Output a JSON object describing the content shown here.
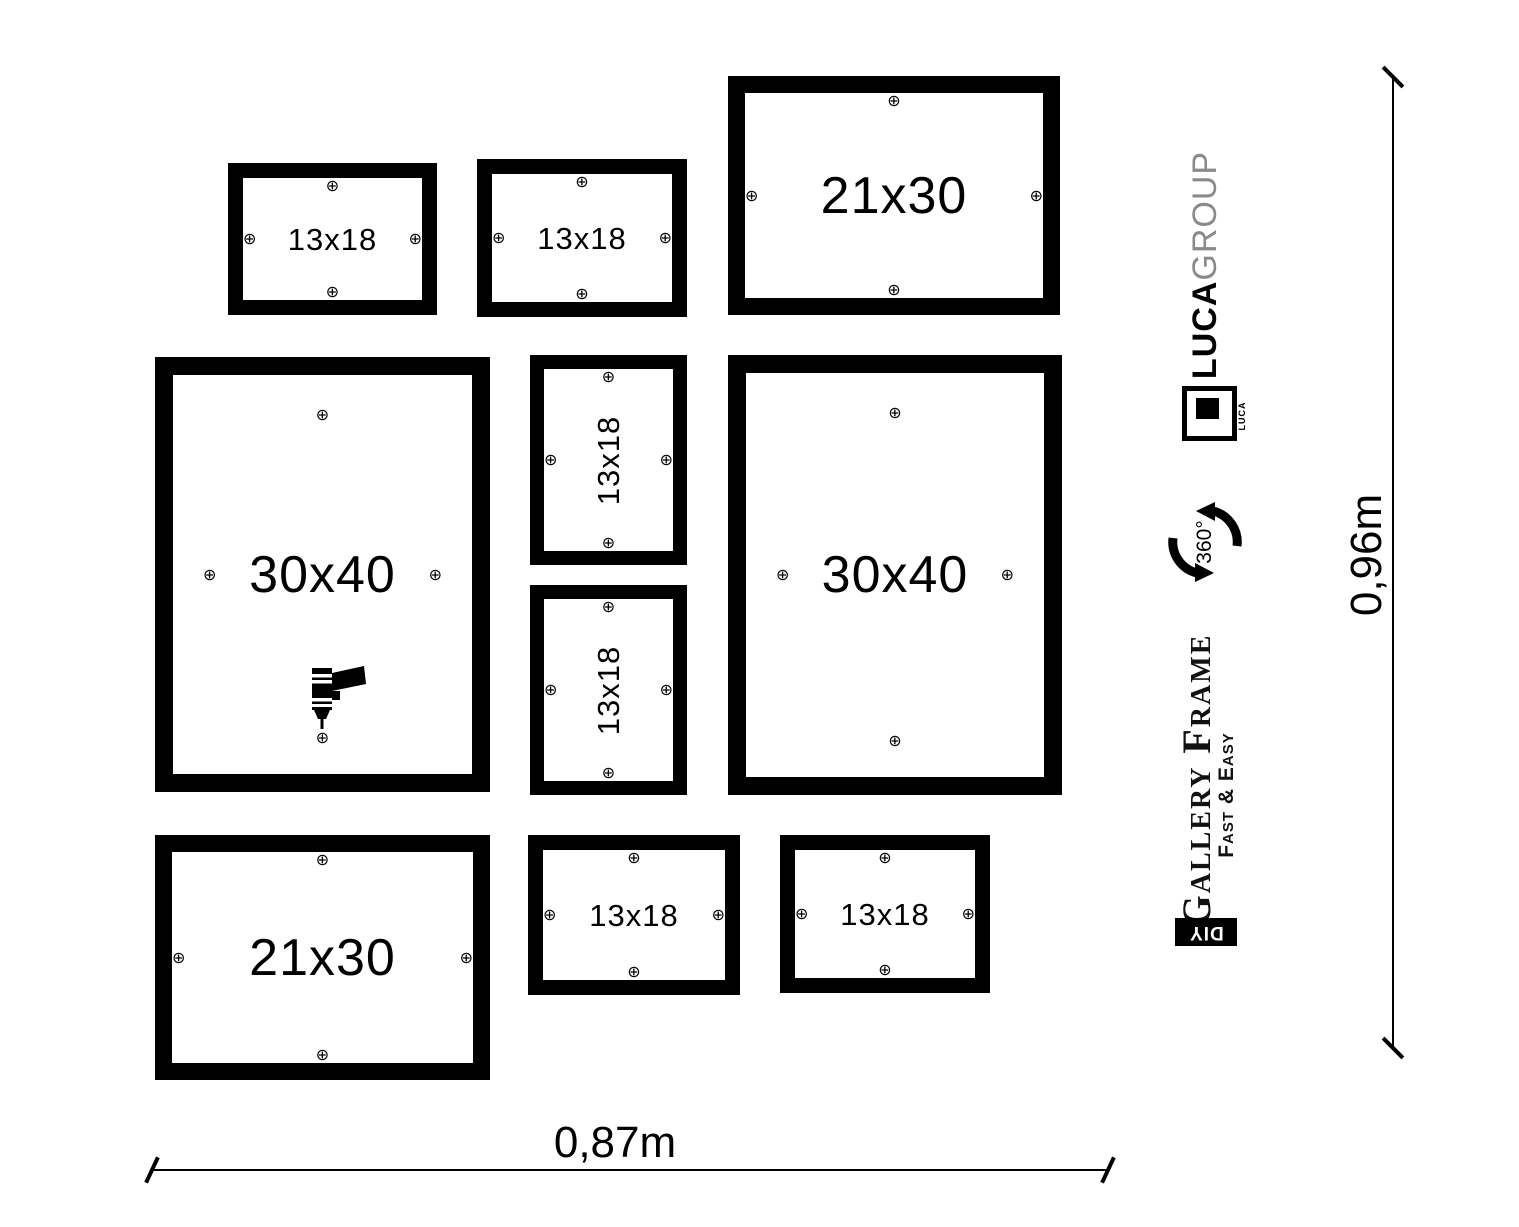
{
  "glyphs": {
    "screw": "⊕"
  },
  "frames": [
    {
      "label": "13x18"
    },
    {
      "label": "13x18"
    },
    {
      "label": "21x30"
    },
    {
      "label": "30x40"
    },
    {
      "label": "13x18"
    },
    {
      "label": "13x18"
    },
    {
      "label": "30x40"
    },
    {
      "label": "21x30"
    },
    {
      "label": "13x18"
    },
    {
      "label": "13x18"
    }
  ],
  "branding": {
    "brand_bold": "LUCA",
    "brand_light": "GROUP",
    "logo_text": "LUCA",
    "rotation_label": "360°",
    "product_name": "Gallery Frame",
    "tagline": "Fast & Easy",
    "diy_label": "DIY"
  },
  "dimensions": {
    "width_label": "0,87m",
    "height_label": "0,96m"
  },
  "colors": {
    "ink": "#000000",
    "brand_gray": "#8a8a8a",
    "background": "#ffffff"
  }
}
